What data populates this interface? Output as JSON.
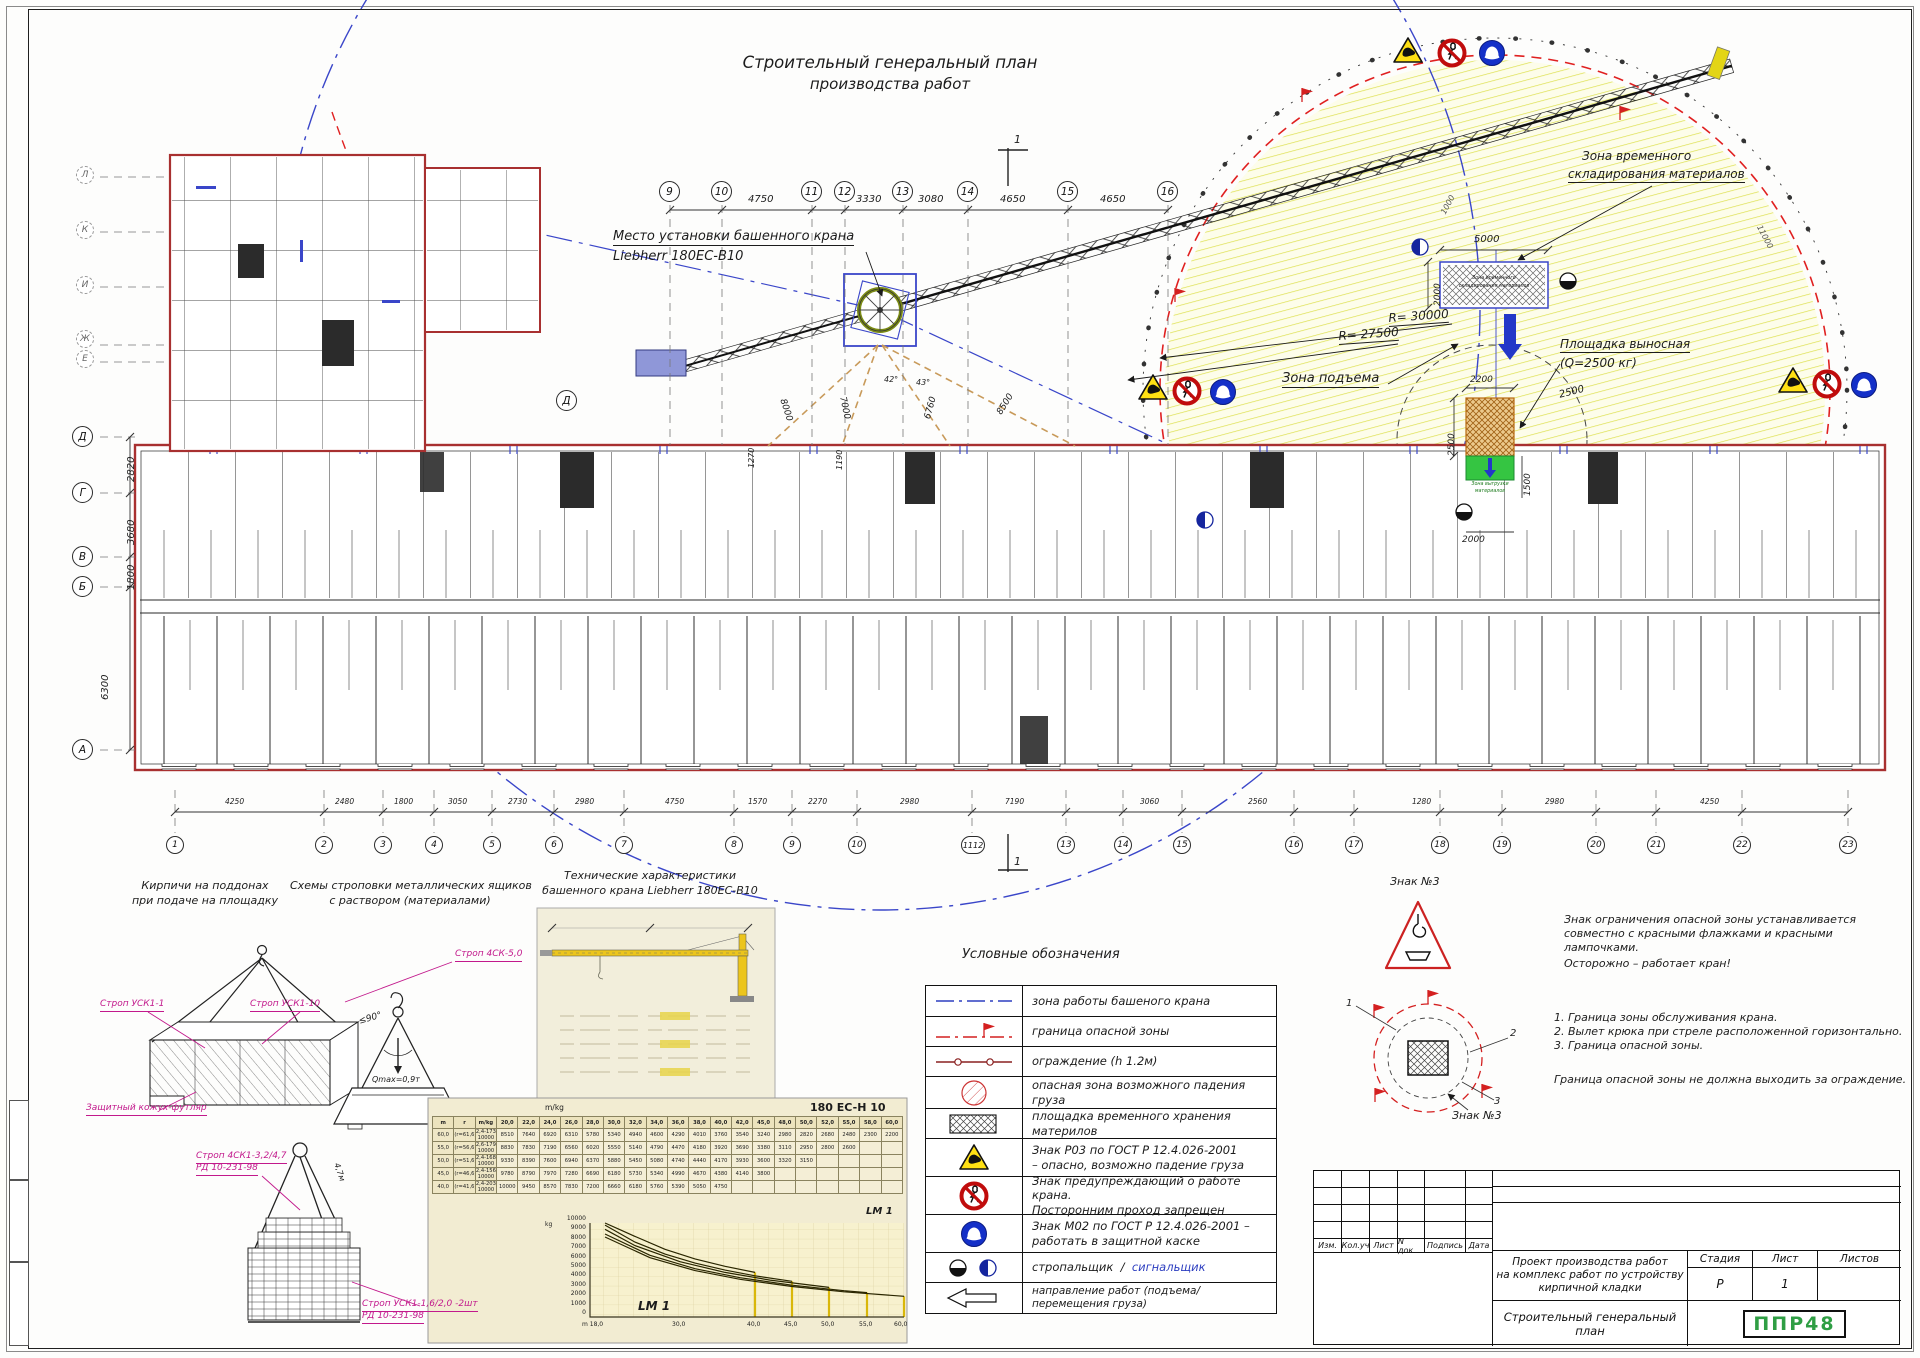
{
  "sheet": {
    "title": [
      "Строительный генеральный план",
      "производства работ"
    ]
  },
  "plan": {
    "crane_label": [
      "Место установки башенного крана",
      "Liebherr 180EC-B10"
    ],
    "storage_label": [
      "Зона временного",
      "складирования материалов"
    ],
    "storage_inner": [
      "Зона временного",
      "складирования материалов"
    ],
    "lift_zone": "Зона подъема",
    "platform_label": [
      "Площадка выносная",
      "(Q=2500 кг)"
    ],
    "unload_label": [
      "Зона выгрузки",
      "материалов"
    ],
    "radius1": "R= 30000",
    "radius2": "R= 27500",
    "dims": {
      "w5000": "5000",
      "h2000": "2000",
      "w2200": "2200",
      "h2500": "2500",
      "s2500": "2500",
      "r1500": "1500",
      "b2000": "2000",
      "a1000": "1000",
      "a11000": "11000"
    },
    "top_axes": [
      "9",
      "10",
      "11",
      "12",
      "13",
      "14",
      "15",
      "16"
    ],
    "top_dims": [
      "4750",
      "3330",
      "3080",
      "4650",
      "4650"
    ],
    "left_axes": [
      "Л",
      "К",
      "И",
      "Ж",
      "Е",
      "Д",
      "Г",
      "В",
      "Б",
      "А"
    ],
    "left_dims": [
      "2820",
      "3680",
      "1800",
      "6300"
    ],
    "axis_d": "Д",
    "bottom_axes": [
      "1",
      "2",
      "3",
      "4",
      "5",
      "6",
      "7",
      "8",
      "9",
      "10",
      "1112",
      "13",
      "14",
      "15",
      "16",
      "17",
      "18",
      "19",
      "20",
      "21",
      "22",
      "23"
    ],
    "bottom_dims": [
      "4250",
      "2480",
      "1800",
      "3050",
      "2730",
      "2980",
      "4750",
      "1570",
      "2270",
      "2980",
      "7190",
      "3060",
      "2560",
      "1280",
      "2980",
      "4250"
    ],
    "guy_dims": [
      "8000",
      "7000",
      "6760",
      "8500"
    ],
    "vert_dims": [
      "1270",
      "1190"
    ],
    "angles": [
      "42°",
      "43°"
    ],
    "marker": "1"
  },
  "legend": {
    "title": "Условные обозначения",
    "rows": [
      {
        "t1": "зона работы башеного крана"
      },
      {
        "t1": "граница опасной зоны"
      },
      {
        "t1": "ограждение (h 1.2м)"
      },
      {
        "t1": "опасная зона возможного падения груза"
      },
      {
        "t1": "площадка временного хранения материлов"
      },
      {
        "t1": "Знак Р03 по ГОСТ Р 12.4.026-2001",
        "t2": "– опасно, возможно падение груза"
      },
      {
        "t1": "Знак предупреждающий о работе крана.",
        "t2": "Посторонним проход запрещен"
      },
      {
        "t1": "Знак М02 по ГОСТ Р 12.4.026-2001 –",
        "t2": "работать в защитной каске"
      },
      {
        "t1": "стропальщик",
        "sep": "/",
        "t2": "сигнальщик"
      },
      {
        "t1": "направление работ (подъема/ перемещения груза)"
      }
    ]
  },
  "sketches": {
    "bricks_title": [
      "Кирпичи на поддонах",
      "при подаче на площадку"
    ],
    "slings_title": [
      "Схемы строповки металлических ящиков",
      "с раствором (материалами)"
    ],
    "sling1": "Строп 4СК-5,0",
    "sling2": "Строп УСК1-1",
    "sling3": "Строп УСК1-10",
    "cover": "Защитный кожух-футляр",
    "qmax": "Qmax=0,9т",
    "angle90": "≤90°",
    "len47": "4,7м",
    "sling4": [
      "Строп 4СК1-3,2/4,7",
      "РД 10-231-98"
    ],
    "sling5": [
      "Строп УСК1-1,6/2,0 -2шт",
      "РД 10-231-98"
    ]
  },
  "specs": {
    "title": [
      "Технические характеристики",
      "башенного крана Liebherr 180EC-B10"
    ]
  },
  "load_chart": {
    "model": "180 EC-H 10",
    "unit": "m/kg",
    "lm1": "LM 1",
    "kg": "kg",
    "table": [
      [
        "m",
        "r",
        "m/kg",
        "20,0",
        "22,0",
        "24,0",
        "26,0",
        "28,0",
        "30,0",
        "32,0",
        "34,0",
        "36,0",
        "38,0",
        "40,0",
        "42,0",
        "45,0",
        "48,0",
        "50,0",
        "52,0",
        "55,0",
        "58,0",
        "60,0"
      ],
      [
        "60,0",
        "(r=61,6)",
        "2,4-173\n10000",
        "8510",
        "7640",
        "6920",
        "6310",
        "5780",
        "5340",
        "4940",
        "4600",
        "4290",
        "4010",
        "3760",
        "3540",
        "3240",
        "2980",
        "2820",
        "2680",
        "2480",
        "2300",
        "2200"
      ],
      [
        "55,0",
        "(r=56,6)",
        "2,6-179\n10000",
        "8830",
        "7830",
        "7190",
        "6560",
        "6020",
        "5550",
        "5140",
        "4790",
        "4470",
        "4180",
        "3920",
        "3690",
        "3380",
        "3110",
        "2950",
        "2800",
        "2600",
        "",
        ""
      ],
      [
        "50,0",
        "(r=51,6)",
        "2,4-168\n10000",
        "9330",
        "8390",
        "7600",
        "6940",
        "6370",
        "5880",
        "5450",
        "5080",
        "4740",
        "4440",
        "4170",
        "3930",
        "3600",
        "3320",
        "3150",
        "",
        "",
        "",
        ""
      ],
      [
        "45,0",
        "(r=46,6)",
        "2,4-156\n10000",
        "9780",
        "8790",
        "7970",
        "7280",
        "6690",
        "6180",
        "5730",
        "5340",
        "4990",
        "4670",
        "4380",
        "4140",
        "3800",
        "",
        "",
        "",
        "",
        "",
        ""
      ],
      [
        "40,0",
        "(r=41,6)",
        "2,4-203\n10000",
        "10000",
        "9450",
        "8570",
        "7830",
        "7200",
        "6660",
        "6180",
        "5760",
        "5390",
        "5050",
        "4750",
        "",
        "",
        "",
        "",
        "",
        "",
        "",
        ""
      ]
    ],
    "yticks": [
      "10000",
      "9000",
      "8000",
      "7000",
      "6000",
      "5000",
      "4000",
      "3000",
      "2000",
      "1000",
      "0"
    ],
    "xticks": [
      "m 18,0",
      "30,0",
      "40,0",
      "45,0",
      "50,0",
      "55,0",
      "60,0"
    ]
  },
  "notes": {
    "sign_no": "Знак №3",
    "warning": [
      "Знак ограничения опасной зоны устанавливается",
      "совместно с красными флажками и красными",
      "лампочками.",
      "Осторожно – работает кран!"
    ],
    "list": [
      "1. Граница зоны обслуживания крана.",
      "2. Вылет крюка при стреле расположенной горизонтально.",
      "3. Граница опасной зоны."
    ],
    "footer": "Граница опасной зоны не должна выходить за ограждение.",
    "callouts": [
      "1",
      "2",
      "3"
    ]
  },
  "titleblock": {
    "rev_cols": [
      "Изм.",
      "Кол.уч",
      "Лист",
      "N док.",
      "Подпись",
      "Дата"
    ],
    "project": [
      "Проект производства работ",
      "на комплекс работ по устройству",
      "кирпичной кладки"
    ],
    "stage_h": "Стадия",
    "sheet_h": "Лист",
    "sheets_h": "Листов",
    "stage": "Р",
    "sheet_no": "1",
    "sheets": "",
    "doc_title": "Строительный генеральный план",
    "logo": "ППР48",
    "logo_color": "#2f9e44"
  },
  "chart_data": {
    "type": "line",
    "title": "180 EC-H 10",
    "xlabel": "m",
    "ylabel": "kg",
    "ylim": [
      0,
      10000
    ],
    "legend": "LM 1",
    "x": [
      20,
      22,
      24,
      26,
      28,
      30,
      32,
      34,
      36,
      38,
      40,
      42,
      45,
      48,
      50,
      52,
      55,
      58,
      60
    ],
    "series": [
      {
        "name": "60,0 (r=61,6)",
        "values": [
          8510,
          7640,
          6920,
          6310,
          5780,
          5340,
          4940,
          4600,
          4290,
          4010,
          3760,
          3540,
          3240,
          2980,
          2820,
          2680,
          2480,
          2300,
          2200
        ]
      },
      {
        "name": "55,0 (r=56,6)",
        "values": [
          8830,
          7830,
          7190,
          6560,
          6020,
          5550,
          5140,
          4790,
          4470,
          4180,
          3920,
          3690,
          3380,
          3110,
          2950,
          2800,
          2600
        ]
      },
      {
        "name": "50,0 (r=51,6)",
        "values": [
          9330,
          8390,
          7600,
          6940,
          6370,
          5880,
          5450,
          5080,
          4740,
          4440,
          4170,
          3930,
          3600,
          3320,
          3150
        ]
      },
      {
        "name": "45,0 (r=46,6)",
        "values": [
          9780,
          8790,
          7970,
          7280,
          6690,
          6180,
          5730,
          5340,
          4990,
          4670,
          4380,
          4140,
          3800
        ]
      },
      {
        "name": "40,0 (r=41,6)",
        "values": [
          10000,
          9450,
          8570,
          7830,
          7200,
          6660,
          6180,
          5760,
          5390,
          5050,
          4750
        ]
      }
    ]
  }
}
